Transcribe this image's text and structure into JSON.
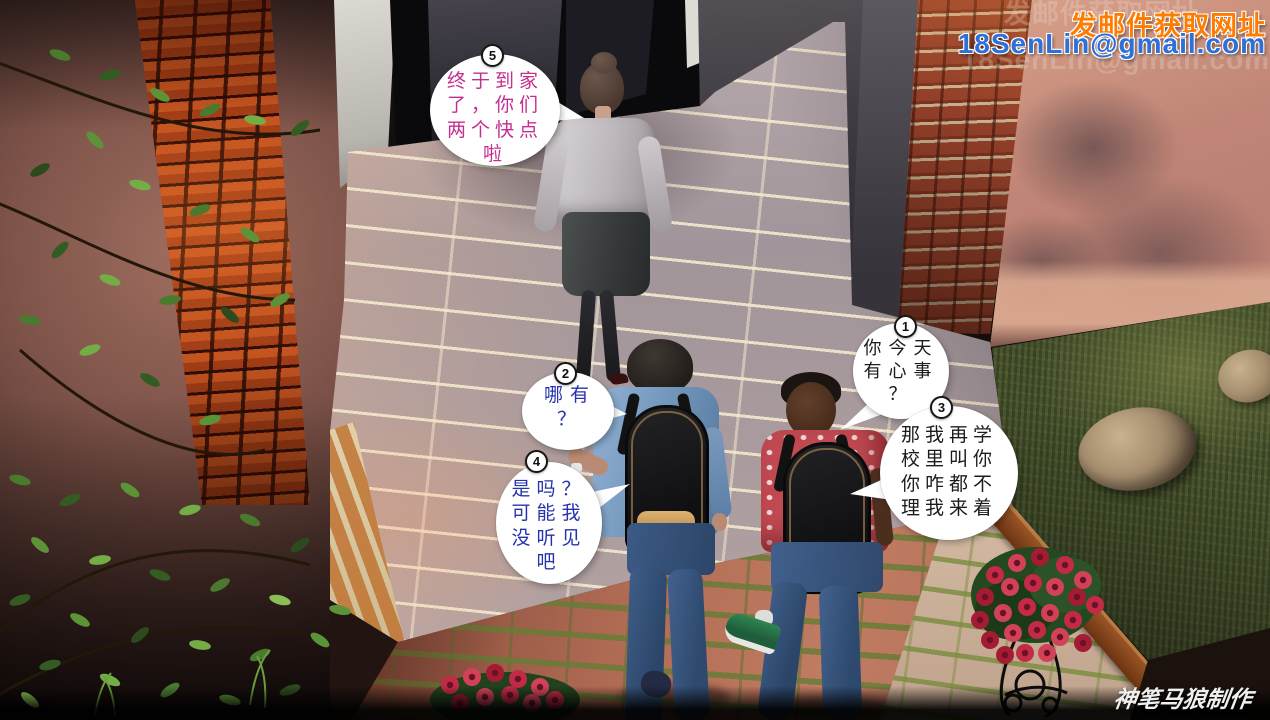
{
  "watermark_top": {
    "line1": "发邮件获取网址",
    "line2": "18SenLin@gmail.com",
    "line1_color": "#ff7c00",
    "line2_color": "#2e6fd8"
  },
  "credit": {
    "text": "神笔马狼制作",
    "color": "#efefef"
  },
  "bubbles": [
    {
      "number": "1",
      "text": "你今天\n有心事\n？",
      "color": "#1c1c1c"
    },
    {
      "number": "2",
      "text": "哪有\n？",
      "color": "#2733ad"
    },
    {
      "number": "3",
      "text": "那我再学\n校里叫你\n你咋都不\n理我来着",
      "color": "#1c1c1c"
    },
    {
      "number": "4",
      "text": "是吗？\n可能我\n没听见\n吧",
      "color": "#2733ad"
    },
    {
      "number": "5",
      "text": "终于到家\n了，你们\n两个快点\n啦",
      "color": "#c42e8e"
    }
  ]
}
